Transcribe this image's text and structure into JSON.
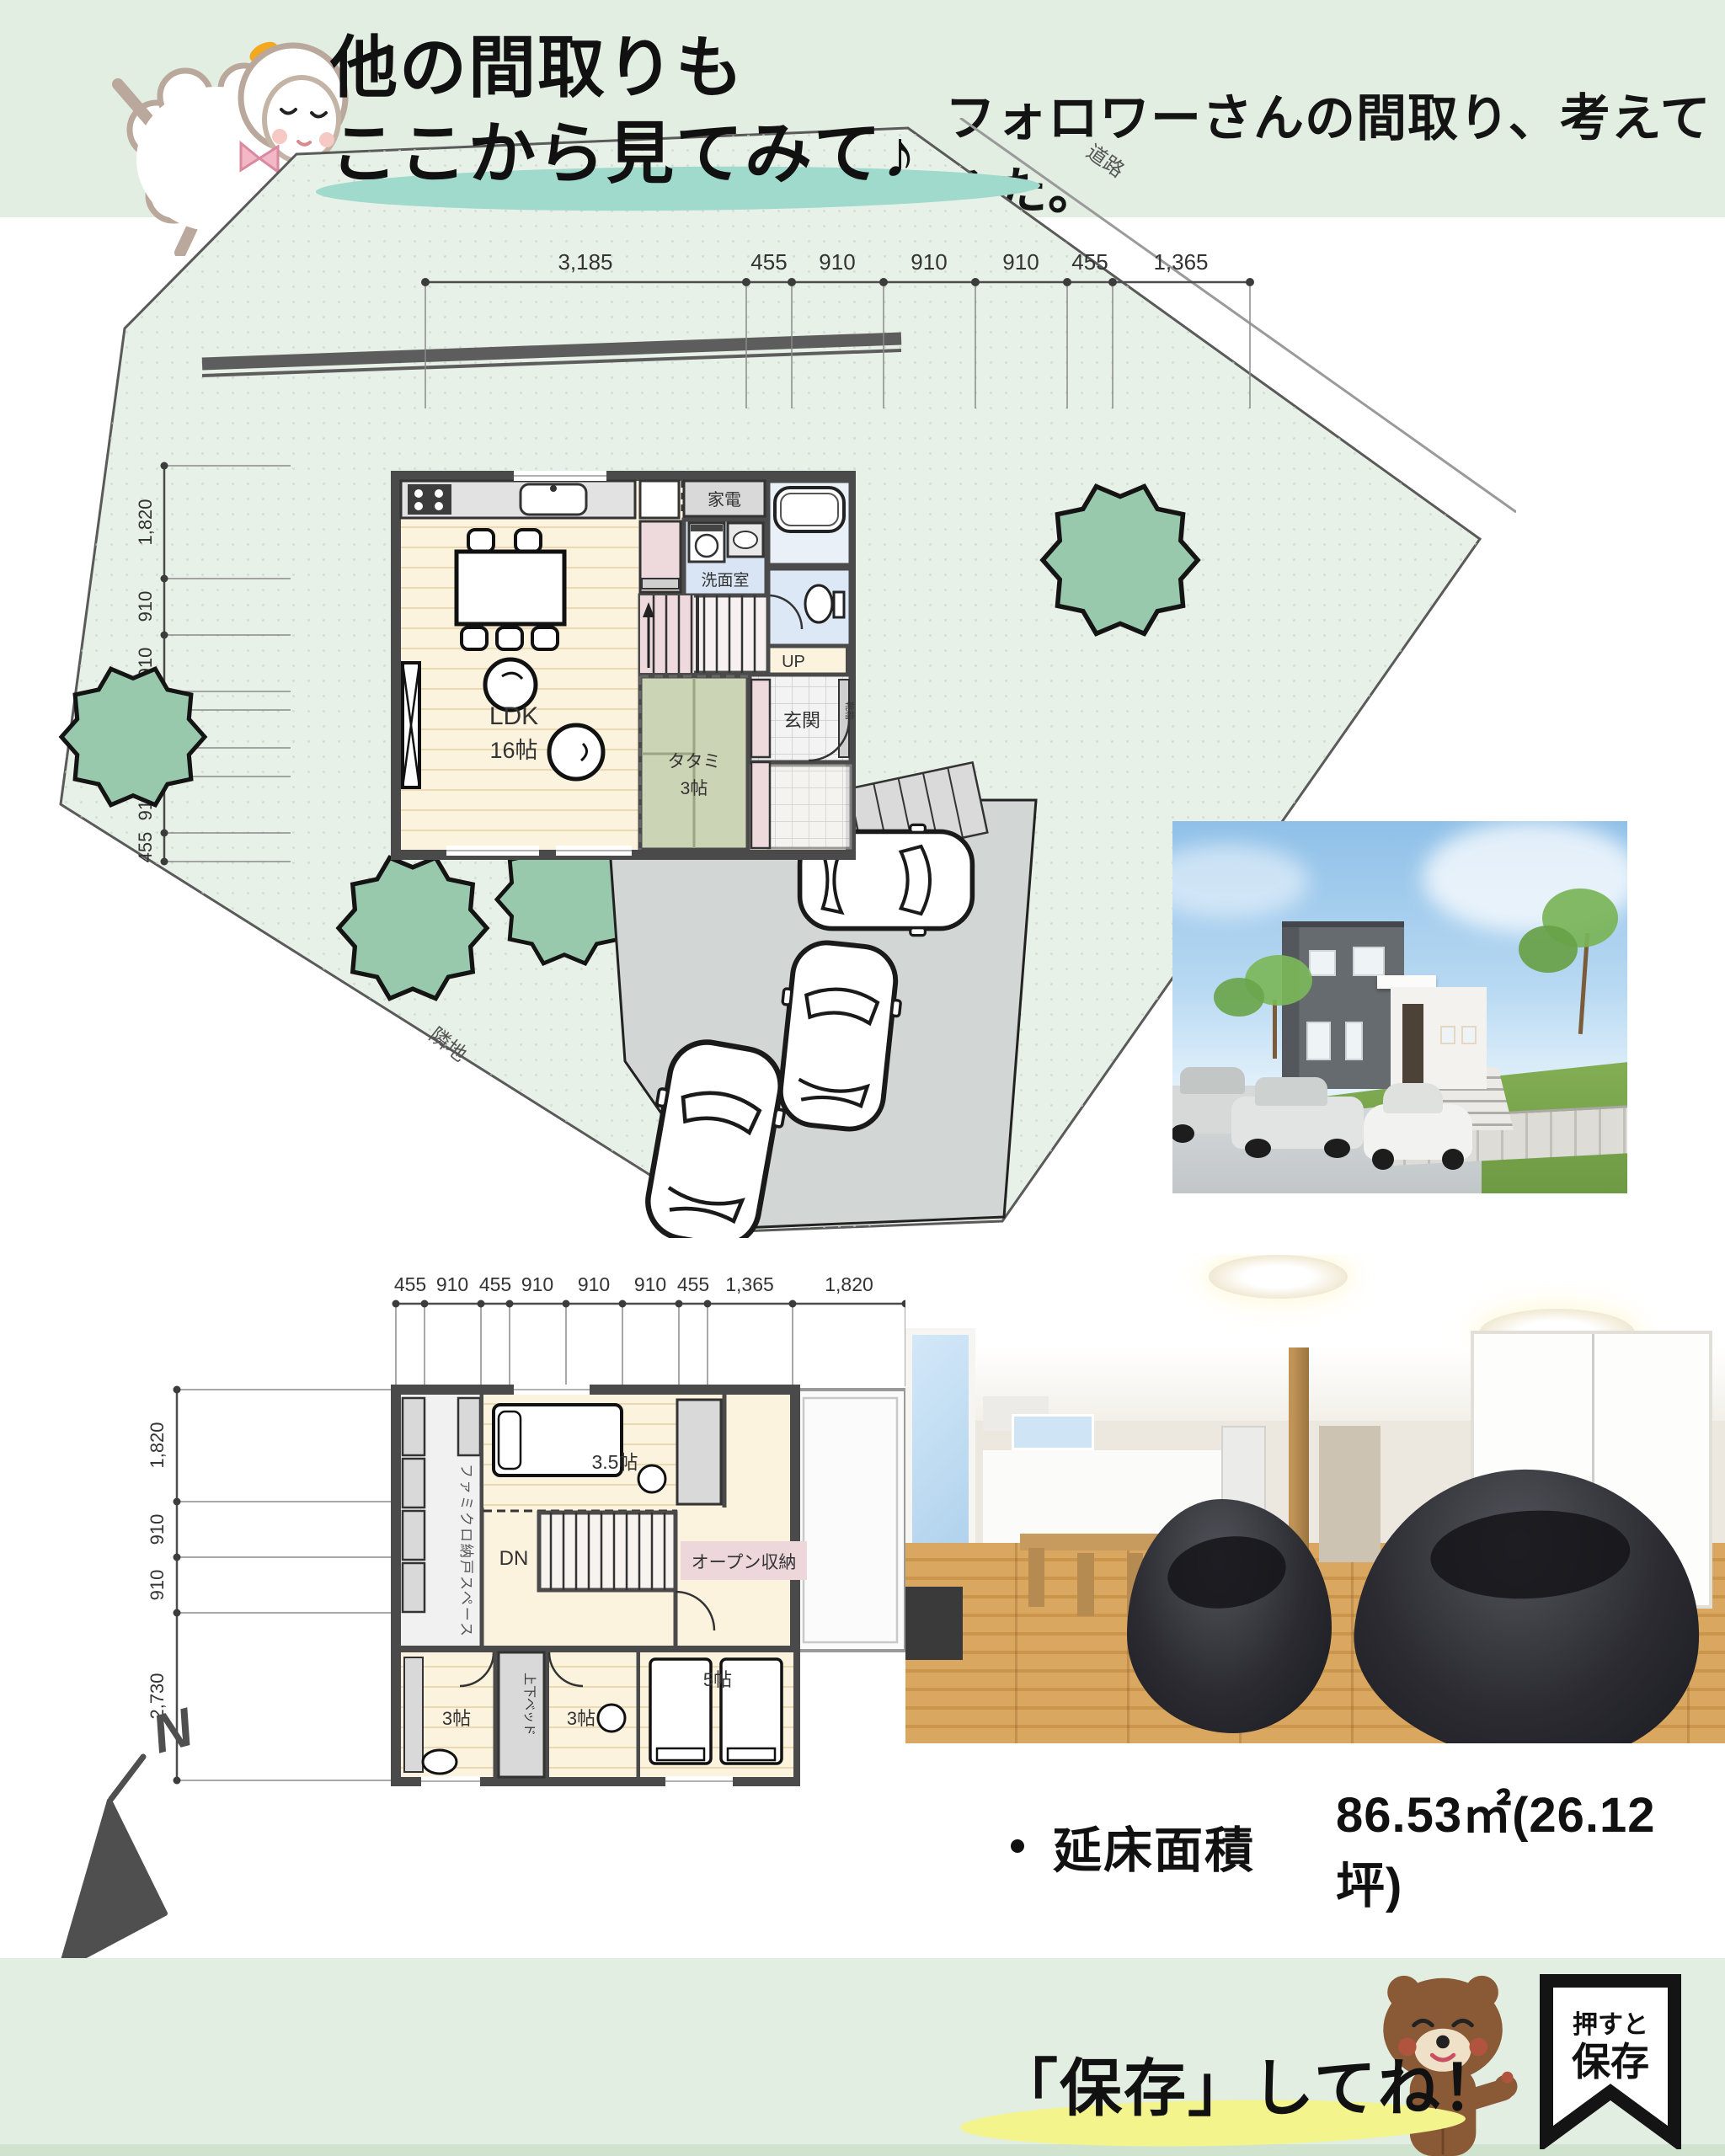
{
  "header": {
    "title_line1": "他の間取りも",
    "title_line2": "ここから見てみて♪",
    "subtitle": "フォロワーさんの間取り、考えてみた。"
  },
  "site_plan": {
    "road_label": "道路",
    "neighbor_label": "隣地",
    "dims_top": [
      "3,185",
      "455",
      "910",
      "910",
      "910",
      "455",
      "1,365"
    ],
    "dims_left": [
      "1,820",
      "910",
      "910",
      "303",
      "607",
      "455",
      "910",
      "455"
    ]
  },
  "floor1": {
    "kaden": "家電",
    "washroom": "洗面室",
    "up": "UP",
    "ldk_name": "LDK",
    "ldk_size": "16帖",
    "tatami_name": "タタミ",
    "tatami_size": "3帖",
    "genkan": "玄関",
    "shoebox": "靴箱"
  },
  "floor2": {
    "dims_top": [
      "455",
      "910",
      "455",
      "910",
      "910",
      "910",
      "455",
      "1,365",
      "1,820"
    ],
    "dims_left": [
      "1,820",
      "910",
      "910",
      "2,730"
    ],
    "closet": "ファミクロ納戸スペース",
    "dn": "DN",
    "open_storage": "オープン収納",
    "room_35": "3.5帖",
    "room_3a": "3帖",
    "bunk_bed": "上下ベッド",
    "room_3b": "3帖",
    "room_5": "5帖"
  },
  "areas": {
    "floor_label": "延床面積",
    "floor_value": "86.53㎡(26.12坪)",
    "land_label": "土地面積",
    "land_value": "313.14㎡(94.72坪)"
  },
  "footer": {
    "cta": "「保存」してね！",
    "bookmark_top": "押すと",
    "bookmark_bottom": "保存"
  },
  "compass": {
    "label": "N"
  }
}
